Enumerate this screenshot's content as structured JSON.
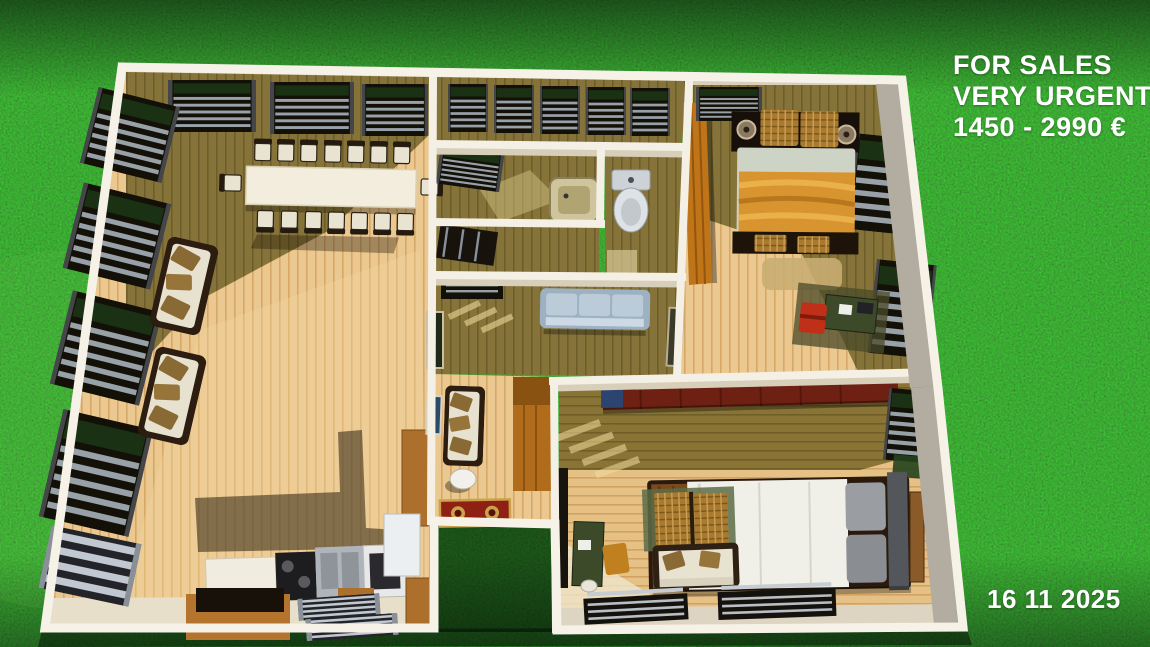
{
  "listing": {
    "line1": "FOR SALES",
    "line2": "VERY URGENTE",
    "line3": "1450 - 2990 €",
    "date": "16 11 2025",
    "text_color": "#ffffff"
  },
  "scene": {
    "type": "3d-floorplan-top-down-render",
    "background": "grass-lawn",
    "colors": {
      "grass": "#2a641f",
      "grass_shadow": "#10300c",
      "wall_white": "#f5f0e5",
      "wall_face_gray": "#b3aca0",
      "floor_light_wood": "#eac88f",
      "floor_olive_wood": "#857339",
      "window_blinds_dark": "#131008",
      "blind_slats_silver": "#98a0a8",
      "sofa_cushion_white": "#e7e1cf",
      "pillow_brown": "#8a6a34",
      "gray_sofa": "#a9bccd",
      "wardrobe_orange": "#bf7418",
      "wardrobe_dark_red": "#6e2113",
      "bed_blanket_orange": "#d8942e",
      "bed_duvet_white": "#f0efe8",
      "kitchen_cork": "#b5742e",
      "rug_red": "#8e2113",
      "desk_green": "#3c4a2a",
      "chair_red": "#c03018",
      "chair_orange": "#c08020"
    }
  },
  "floorplan": {
    "rooms": [
      {
        "name": "open dining living room",
        "furniture": [
          "long dining table",
          "16 chairs",
          "2 white sofas with brown pillows",
          "window blinds on top wall",
          "window blinds on left wall",
          "radiator"
        ]
      },
      {
        "name": "kitchen corner",
        "furniture": [
          "counter with sink cooktop and oven",
          "cork island with black top",
          "fridge",
          "tall cork cabinet",
          "radiators"
        ]
      },
      {
        "name": "top hallway room",
        "furniture": [
          "five windows with blinds"
        ]
      },
      {
        "name": "bathroom",
        "furniture": [
          "window with blinds",
          "bathtub basin"
        ]
      },
      {
        "name": "wc",
        "furniture": [
          "toilet"
        ]
      },
      {
        "name": "storage room",
        "furniture": [
          "dark louvered door"
        ]
      },
      {
        "name": "central living room",
        "furniture": [
          "gray three-seat sofa",
          "wall art",
          "window blinds"
        ]
      },
      {
        "name": "entry vestibule",
        "furniture": [
          "tall wooden wardrobe",
          "bench sofa with pillows",
          "white oval stool",
          "red oriental rug",
          "wall picture"
        ]
      },
      {
        "name": "bedroom top right",
        "furniture": [
          "double bed with orange blanket",
          "dark headboard with round speakers",
          "wicker pillows and baskets",
          "orange wardrobe",
          "two windows with blinds",
          "desk with red chair",
          "tan rug"
        ]
      },
      {
        "name": "bedroom bottom right",
        "furniture": [
          "double bed with white duvet and gray headboard",
          "dark red wardrobe",
          "bench sofa with pillows",
          "wicker chests on green mat",
          "desk with orange chair",
          "stool",
          "radiators",
          "window with blinds",
          "nightstand"
        ]
      }
    ]
  }
}
